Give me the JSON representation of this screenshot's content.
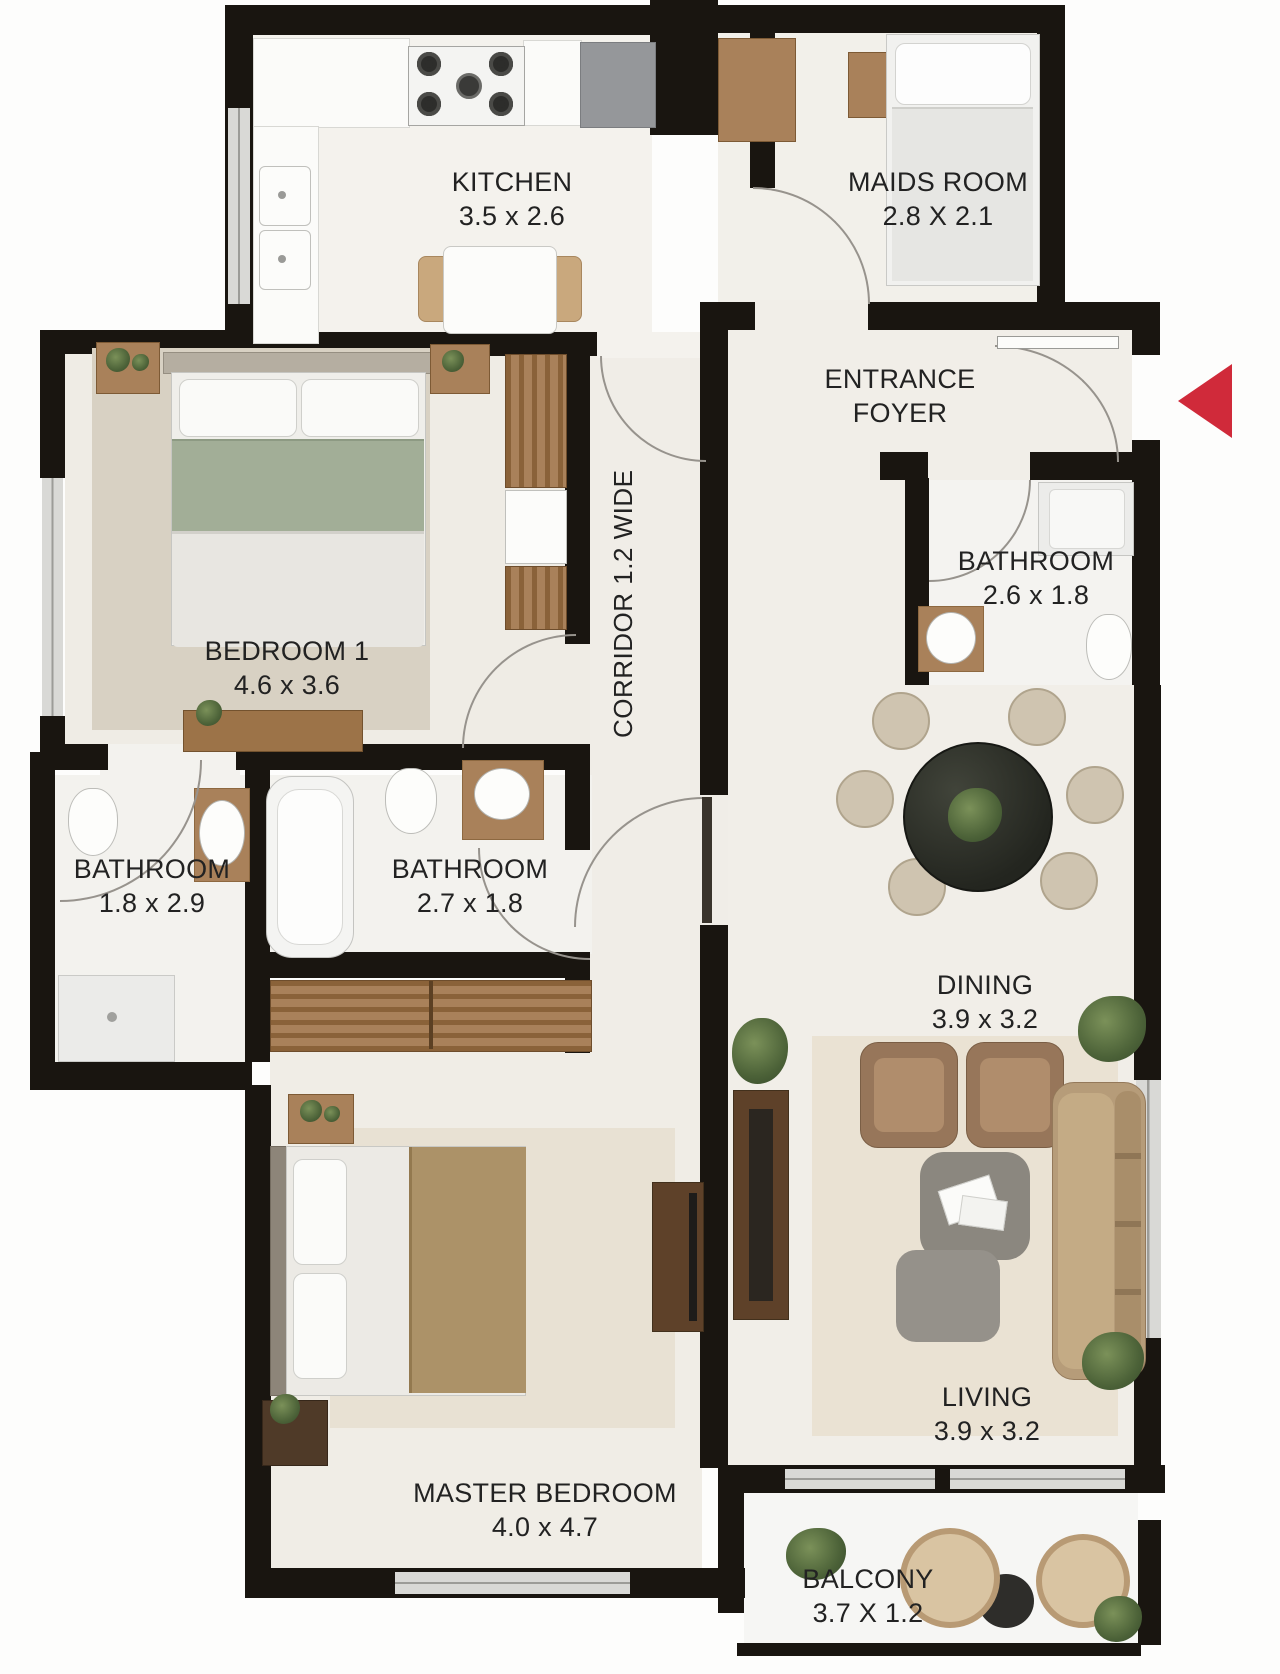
{
  "title": "Apartment Floor Plan",
  "colors": {
    "wall": "#191510",
    "floor": "#f1eee8",
    "floor_light": "#f4f3f0",
    "rug": "#d8d1c3",
    "rug_living": "#eae2d3",
    "wood": "#a9815a",
    "wood_dark": "#5e4129",
    "green_bed": "#a2ae97",
    "window": "#d9d9d6",
    "text": "#222222",
    "arrow": "#d02a3a"
  },
  "rooms": {
    "kitchen": {
      "name": "KITCHEN",
      "dims": "3.5 x 2.6"
    },
    "maids": {
      "name": "MAIDS ROOM",
      "dims": "2.8 X 2.1"
    },
    "foyer": {
      "line1": "ENTRANCE",
      "line2": "FOYER"
    },
    "bath_entry": {
      "name": "BATHROOM",
      "dims": "2.6 x 1.8"
    },
    "corridor": {
      "name": "CORRIDOR 1.2 WIDE"
    },
    "bedroom1": {
      "name": "BEDROOM 1",
      "dims": "4.6 x 3.6"
    },
    "bath_left": {
      "name": "BATHROOM",
      "dims": "1.8 x 2.9"
    },
    "bath_mid": {
      "name": "BATHROOM",
      "dims": "2.7 x 1.8"
    },
    "dining": {
      "name": "DINING",
      "dims": "3.9 x 3.2"
    },
    "living": {
      "name": "LIVING",
      "dims": "3.9 x 3.2"
    },
    "master": {
      "name": "MASTER BEDROOM",
      "dims": "4.0 x 4.7"
    },
    "balcony": {
      "name": "BALCONY",
      "dims": "3.7 X 1.2"
    }
  }
}
